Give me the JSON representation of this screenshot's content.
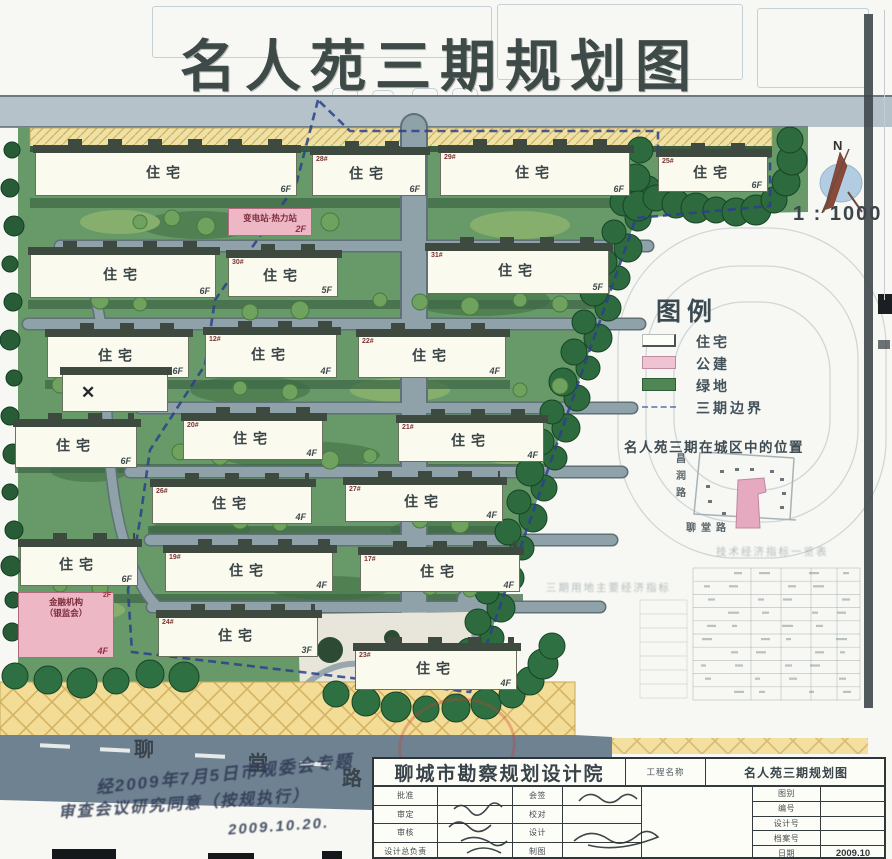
{
  "title": "名人苑三期规划图",
  "north": {
    "label": "N",
    "scale": "1 : 1000"
  },
  "legend": {
    "title": "图例",
    "items": [
      {
        "swatch": "residential",
        "label": "住宅"
      },
      {
        "swatch": "public",
        "label": "公建"
      },
      {
        "swatch": "green",
        "label": "绿地"
      },
      {
        "swatch": "boundary",
        "label": "三期边界"
      }
    ]
  },
  "inset": {
    "caption": "名人苑三期在城区中的位置",
    "road_vertical": [
      "昌",
      "润",
      "路"
    ],
    "road_horizontal": "聊堂路",
    "ghost_caption_left": "三期用地主要经济指标",
    "ghost_caption_right": "技术经济指标一览表"
  },
  "roads": {
    "south_name_chars": [
      "聊",
      "堂",
      "路"
    ]
  },
  "annotations": {
    "handwriting_line1": "经2009年7月5日市规委会专题",
    "handwriting_line2": "审查会议研究同意（按规执行）",
    "handwriting_date": "2009.10.20.",
    "stamp": "red-round-seal"
  },
  "titleblock": {
    "institute": "聊城市勘察规划设计院",
    "project_label": "工程名称",
    "project_name": "名人苑三期规划图",
    "left_rows": [
      "批准",
      "审定",
      "审核",
      "设计总负责"
    ],
    "mid_rows": [
      "会签",
      "校对",
      "设计",
      "制图"
    ],
    "right_rows": [
      {
        "label": "图别",
        "value": ""
      },
      {
        "label": "编号",
        "value": ""
      },
      {
        "label": "设计号",
        "value": ""
      },
      {
        "label": "档案号",
        "value": ""
      },
      {
        "label": "日期",
        "value": "2009.10"
      }
    ]
  },
  "colors": {
    "site_green": "#679a68",
    "tree_dark": "#2d6a3e",
    "road_gray": "#8fa1a9",
    "south_road": "#6f8292",
    "paving_yellow": "#f2dc96",
    "boundary_blue": "#2b3f8c",
    "public_pink": "#eeb7c6",
    "stamp_red": "#c63e34"
  },
  "buildings": [
    {
      "x": 35,
      "y": 152,
      "w": 262,
      "h": 44,
      "label": "住宅",
      "floors": "6F"
    },
    {
      "x": 312,
      "y": 154,
      "w": 114,
      "h": 42,
      "label": "住宅",
      "floors": "6F",
      "num": "28#"
    },
    {
      "x": 440,
      "y": 152,
      "w": 190,
      "h": 44,
      "label": "住宅",
      "floors": "6F",
      "num": "29#"
    },
    {
      "x": 658,
      "y": 156,
      "w": 110,
      "h": 36,
      "label": "住宅",
      "floors": "6F",
      "num": "25#"
    },
    {
      "x": 30,
      "y": 254,
      "w": 186,
      "h": 44,
      "label": "住宅",
      "floors": "6F"
    },
    {
      "x": 228,
      "y": 257,
      "w": 110,
      "h": 40,
      "label": "住宅",
      "floors": "5F",
      "num": "30#"
    },
    {
      "x": 427,
      "y": 250,
      "w": 182,
      "h": 44,
      "label": "住宅",
      "floors": "5F",
      "num": "31#"
    },
    {
      "x": 47,
      "y": 336,
      "w": 142,
      "h": 42,
      "label": "住宅",
      "floors": "6F"
    },
    {
      "x": 205,
      "y": 334,
      "w": 132,
      "h": 44,
      "label": "住宅",
      "floors": "4F",
      "num": "12#"
    },
    {
      "x": 358,
      "y": 336,
      "w": 148,
      "h": 42,
      "label": "住宅",
      "floors": "4F",
      "num": "22#"
    },
    {
      "x": 15,
      "y": 426,
      "w": 122,
      "h": 42,
      "label": "住宅",
      "floors": "6F"
    },
    {
      "x": 183,
      "y": 420,
      "w": 140,
      "h": 40,
      "label": "住宅",
      "floors": "4F",
      "num": "20#"
    },
    {
      "x": 398,
      "y": 422,
      "w": 146,
      "h": 40,
      "label": "住宅",
      "floors": "4F",
      "num": "21#"
    },
    {
      "x": 152,
      "y": 486,
      "w": 160,
      "h": 38,
      "label": "住宅",
      "floors": "4F",
      "num": "26#"
    },
    {
      "x": 345,
      "y": 484,
      "w": 158,
      "h": 38,
      "label": "住宅",
      "floors": "4F",
      "num": "27#"
    },
    {
      "x": 20,
      "y": 546,
      "w": 118,
      "h": 40,
      "label": "住宅",
      "floors": "6F"
    },
    {
      "x": 165,
      "y": 552,
      "w": 168,
      "h": 40,
      "label": "住宅",
      "floors": "4F",
      "num": "19#"
    },
    {
      "x": 360,
      "y": 554,
      "w": 160,
      "h": 38,
      "label": "住宅",
      "floors": "4F",
      "num": "17#"
    },
    {
      "x": 158,
      "y": 617,
      "w": 160,
      "h": 40,
      "label": "住宅",
      "floors": "3F",
      "num": "24#"
    },
    {
      "x": 355,
      "y": 650,
      "w": 162,
      "h": 40,
      "label": "住宅",
      "floors": "4F",
      "num": "23#"
    }
  ],
  "public_buildings": [
    {
      "x": 228,
      "y": 208,
      "w": 84,
      "h": 28,
      "lines": [
        "变电站·热力站"
      ],
      "floors": "2F"
    },
    {
      "x": 18,
      "y": 592,
      "w": 96,
      "h": 66,
      "lines": [
        "金融机构",
        "（银监会）"
      ],
      "floors": "4F",
      "corner": "2F"
    }
  ],
  "club_building": {
    "x": 62,
    "y": 374,
    "w": 106,
    "h": 38,
    "mark": "✕"
  },
  "map": {
    "east_chain": [
      [
        648,
        188
      ],
      [
        638,
        218
      ],
      [
        628,
        248
      ],
      [
        618,
        278
      ],
      [
        608,
        308
      ],
      [
        598,
        338
      ],
      [
        588,
        368
      ],
      [
        577,
        398
      ],
      [
        566,
        428
      ],
      [
        555,
        458
      ],
      [
        544,
        488
      ],
      [
        533,
        518
      ],
      [
        522,
        548
      ],
      [
        511,
        578
      ],
      [
        501,
        608
      ],
      [
        492,
        638
      ],
      [
        484,
        668
      ],
      [
        624,
        202
      ],
      [
        614,
        232
      ],
      [
        604,
        262
      ],
      [
        594,
        292
      ],
      [
        584,
        322
      ],
      [
        574,
        352
      ],
      [
        563,
        382
      ],
      [
        552,
        412
      ],
      [
        541,
        442
      ],
      [
        530,
        472
      ],
      [
        519,
        502
      ],
      [
        508,
        532
      ],
      [
        497,
        562
      ],
      [
        487,
        592
      ],
      [
        478,
        622
      ],
      [
        470,
        652
      ]
    ],
    "ne_trees": [
      [
        640,
        150
      ],
      [
        636,
        178
      ],
      [
        638,
        206
      ],
      [
        656,
        198
      ],
      [
        676,
        204
      ],
      [
        696,
        208
      ],
      [
        716,
        210
      ],
      [
        736,
        212
      ],
      [
        756,
        210
      ],
      [
        774,
        200
      ],
      [
        786,
        182
      ],
      [
        792,
        160
      ],
      [
        790,
        140
      ]
    ],
    "bottom_trees": [
      [
        15,
        676
      ],
      [
        48,
        680
      ],
      [
        82,
        683
      ],
      [
        116,
        681
      ],
      [
        150,
        674
      ],
      [
        184,
        677
      ],
      [
        336,
        694
      ],
      [
        366,
        702
      ],
      [
        396,
        707
      ],
      [
        426,
        709
      ],
      [
        456,
        708
      ],
      [
        486,
        704
      ],
      [
        512,
        695
      ],
      [
        530,
        681
      ],
      [
        543,
        664
      ],
      [
        552,
        646
      ]
    ],
    "left_chain": [
      [
        12,
        150
      ],
      [
        10,
        188
      ],
      [
        14,
        226
      ],
      [
        10,
        264
      ],
      [
        13,
        302
      ],
      [
        10,
        340
      ],
      [
        14,
        378
      ],
      [
        10,
        416
      ],
      [
        13,
        454
      ],
      [
        10,
        492
      ],
      [
        14,
        530
      ],
      [
        11,
        566
      ],
      [
        13,
        600
      ],
      [
        12,
        632
      ]
    ],
    "courtyard_trees": [
      [
        140,
        222
      ],
      [
        172,
        218
      ],
      [
        206,
        226
      ],
      [
        246,
        220
      ],
      [
        282,
        226
      ],
      [
        330,
        222
      ],
      [
        380,
        300
      ],
      [
        420,
        302
      ],
      [
        470,
        306
      ],
      [
        520,
        300
      ],
      [
        560,
        304
      ],
      [
        100,
        300
      ],
      [
        140,
        304
      ],
      [
        60,
        385
      ],
      [
        100,
        390
      ],
      [
        240,
        388
      ],
      [
        290,
        392
      ],
      [
        330,
        460
      ],
      [
        370,
        456
      ],
      [
        180,
        452
      ],
      [
        220,
        456
      ],
      [
        520,
        390
      ],
      [
        560,
        386
      ],
      [
        240,
        520
      ],
      [
        280,
        524
      ],
      [
        420,
        520
      ],
      [
        460,
        524
      ],
      [
        60,
        585
      ],
      [
        100,
        588
      ],
      [
        430,
        586
      ],
      [
        470,
        590
      ],
      [
        250,
        312
      ],
      [
        300,
        310
      ]
    ]
  }
}
